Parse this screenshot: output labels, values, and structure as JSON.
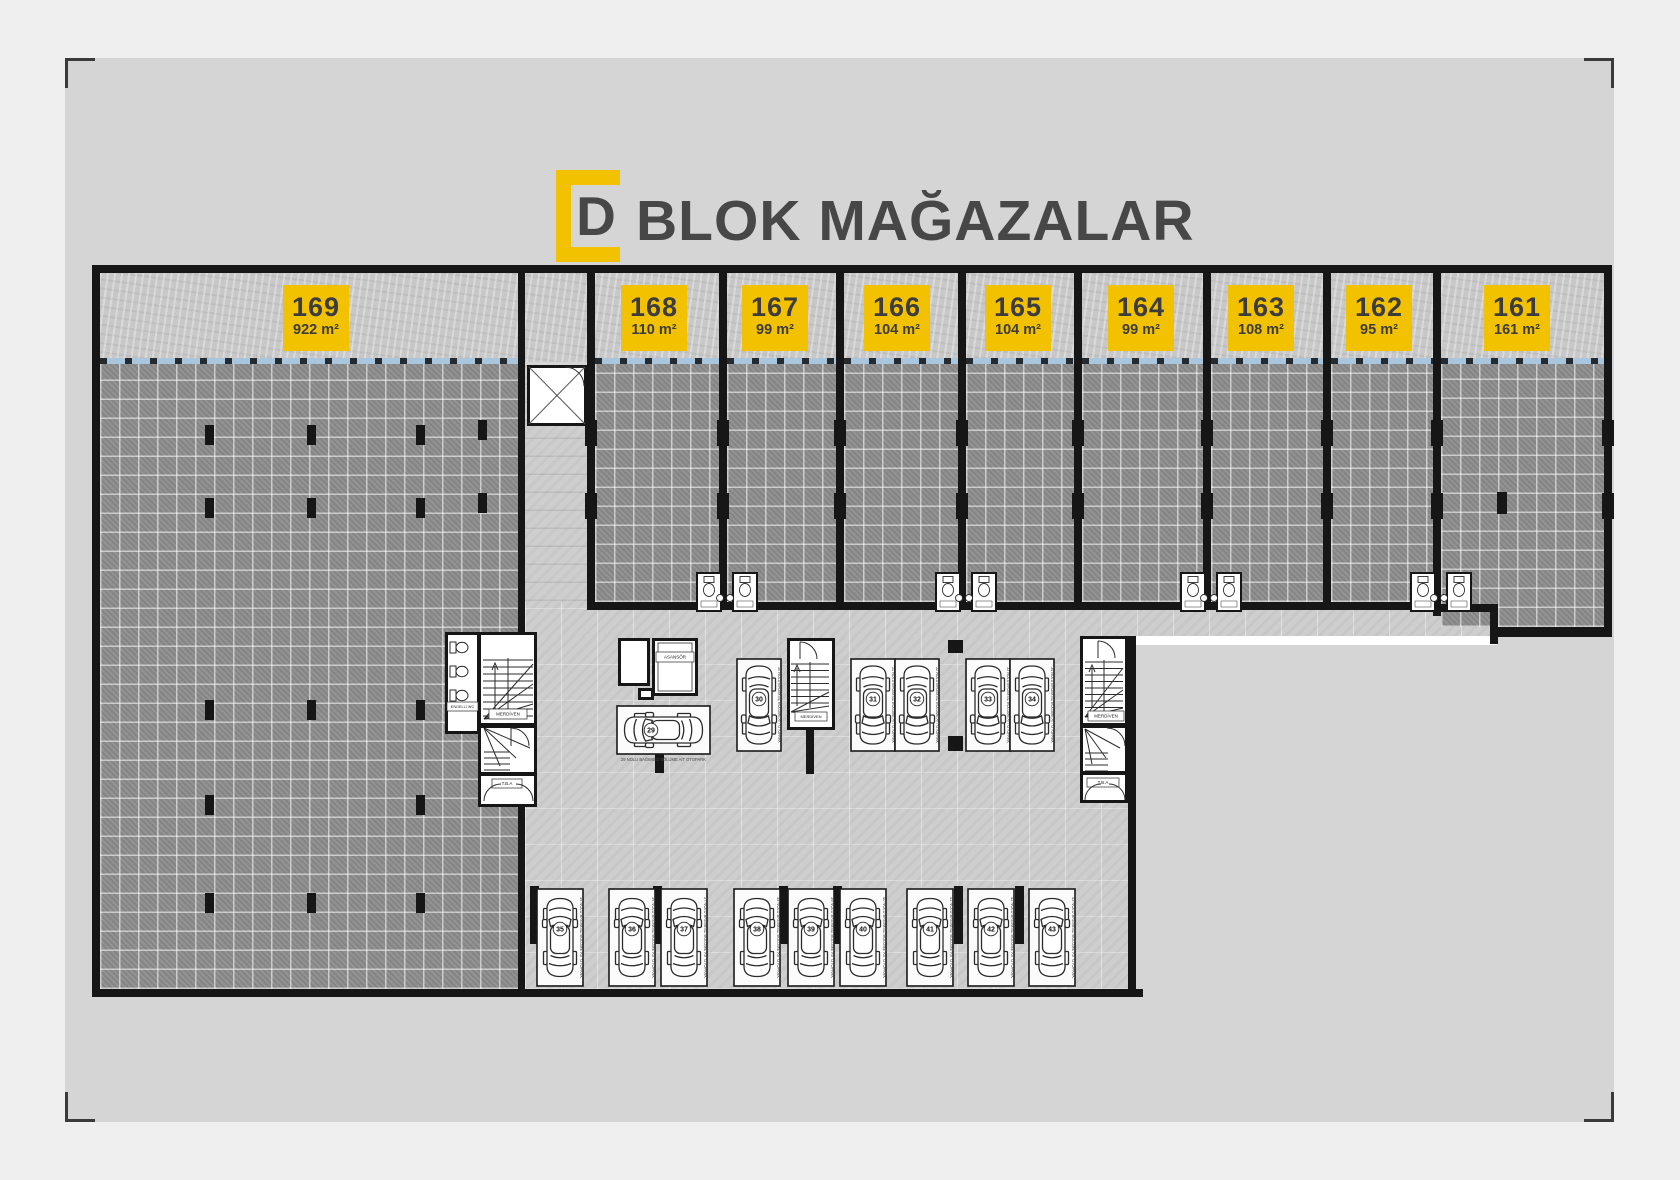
{
  "title": {
    "logo_letter": "D",
    "text": "BLOK MAĞAZALAR"
  },
  "stores": [
    {
      "no": "169",
      "area": "922 m²"
    },
    {
      "no": "168",
      "area": "110 m²"
    },
    {
      "no": "167",
      "area": "99 m²"
    },
    {
      "no": "166",
      "area": "104 m²"
    },
    {
      "no": "165",
      "area": "104 m²"
    },
    {
      "no": "164",
      "area": "99 m²"
    },
    {
      "no": "163",
      "area": "108 m²"
    },
    {
      "no": "162",
      "area": "95 m²"
    },
    {
      "no": "161",
      "area": "161 m²"
    }
  ],
  "parking": {
    "top_spots": [
      "29",
      "30",
      "31",
      "32",
      "33",
      "34"
    ],
    "bottom_spots": [
      "35",
      "36",
      "37",
      "38",
      "39",
      "40",
      "41",
      "42",
      "43"
    ],
    "spot_label_suffix": "NOLU BAĞIMSIZ BÖLÜME AİT OTOPARK"
  },
  "rooms": {
    "elevator": "ASANSÖR",
    "stairs": "MERDİVEN",
    "service": "T.B.A",
    "disabled_wc": "ENGELLİ WC"
  },
  "colors": {
    "accent_yellow": "#f2c100",
    "title_text": "#474747",
    "wall": "#161616",
    "storefront_blue": "#a9c6dd",
    "dark_tile": "#8d8d8d",
    "garage_floor": "#cecece",
    "panel": "#d5d5d5",
    "page_bg": "#efefef"
  }
}
